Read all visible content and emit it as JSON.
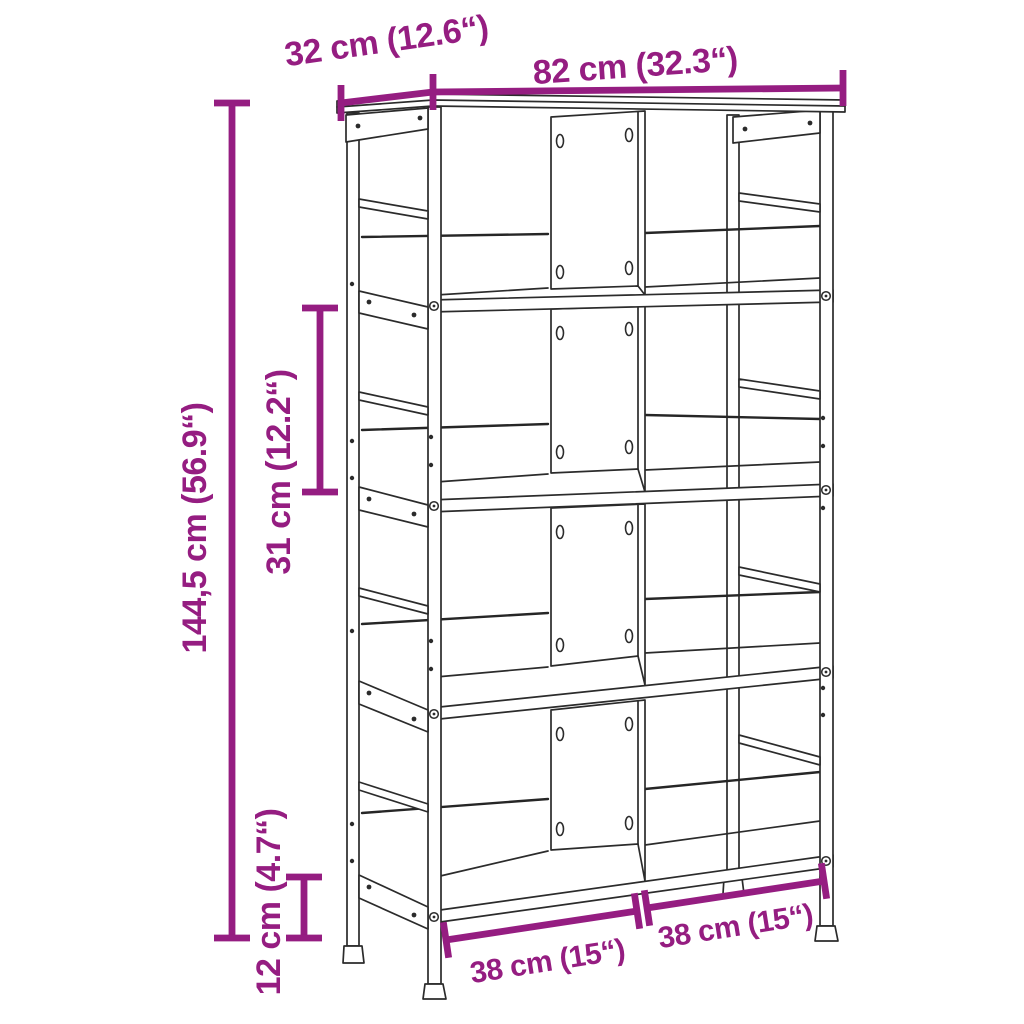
{
  "diagram": {
    "kind": "product-dimension-diagram",
    "subject": "bookshelf with 8 compartments (2 columns, 4 tiers)",
    "accent_color": "#951d81",
    "line_color": "#2b2b2b",
    "background_color": "#ffffff",
    "labels": {
      "depth": "32 cm (12.6“)",
      "width": "82 cm (32.3“)",
      "height": "144,5 cm (56.9“)",
      "shelf_spacing": "31 cm (12.2“)",
      "bottom_clearance": "12 cm (4.7“)",
      "compartment_left": "38 cm (15“)",
      "compartment_right": "38 cm (15“)"
    }
  }
}
